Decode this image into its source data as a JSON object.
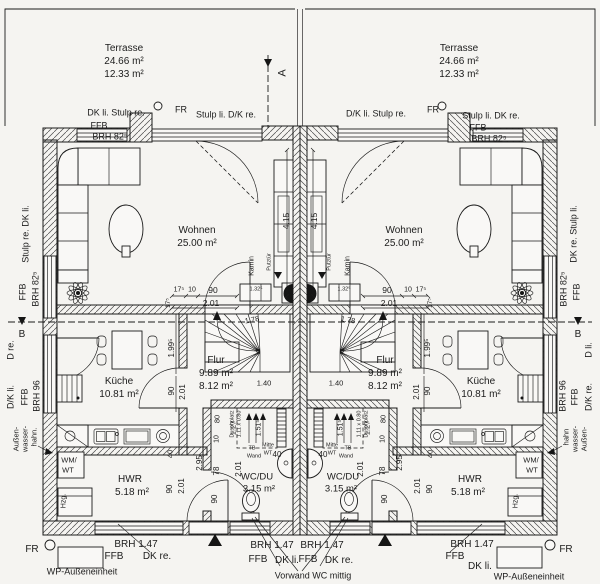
{
  "drawing_type": "floor-plan",
  "rooms": {
    "left_unit": {
      "wohnen": "25.00 m²",
      "kueche": "10.81 m²",
      "flur_1": "9.89 m²",
      "flur_2": "8.12 m²",
      "wc_du": "3.15 m²",
      "hwr": "5.18 m²",
      "terrasse_1": "24.66 m²",
      "terrasse_2": "12.33 m²"
    },
    "right_unit": {
      "wohnen": "25.00 m²",
      "kueche": "10.81 m²",
      "flur_1": "9.89 m²",
      "flur_2": "8.12 m²",
      "wc_du": "3.15 m²",
      "hwr": "5.18 m²",
      "terrasse_1": "24.66 m²",
      "terrasse_2": "12.33 m²"
    }
  },
  "labels": [
    {
      "n": "terrace-left-name",
      "t": "Terrasse",
      "x": 124,
      "y": 49,
      "s": 10
    },
    {
      "n": "terrace-left-area1",
      "t": "24.66 m²",
      "x": 124,
      "y": 62,
      "s": 10
    },
    {
      "n": "terrace-left-area2",
      "t": "12.33 m²",
      "x": 124,
      "y": 75,
      "s": 10
    },
    {
      "n": "terrace-right-name",
      "t": "Terrasse",
      "x": 459,
      "y": 49,
      "s": 10
    },
    {
      "n": "terrace-right-area1",
      "t": "24.66 m²",
      "x": 459,
      "y": 62,
      "s": 10
    },
    {
      "n": "terrace-right-area2",
      "t": "12.33 m²",
      "x": 459,
      "y": 75,
      "s": 10
    },
    {
      "n": "window-label",
      "t": "DK li. Stulp re.",
      "x": 116,
      "y": 113,
      "s": 9
    },
    {
      "n": "window-label",
      "t": "FFB",
      "x": 99,
      "y": 126,
      "s": 9
    },
    {
      "n": "window-label",
      "t": "BRH 82⁵",
      "x": 110,
      "y": 137,
      "s": 9
    },
    {
      "n": "drain-label",
      "t": "FR",
      "x": 181,
      "y": 110,
      "s": 9
    },
    {
      "n": "door-label",
      "t": "Stulp li. D/K re.",
      "x": 226,
      "y": 115,
      "s": 9
    },
    {
      "n": "door-label",
      "t": "D/K li. Stulp re.",
      "x": 376,
      "y": 114,
      "s": 9
    },
    {
      "n": "drain-label",
      "t": "FR",
      "x": 433,
      "y": 110,
      "s": 9
    },
    {
      "n": "window-label",
      "t": "Stulp li. DK re.",
      "x": 491,
      "y": 116,
      "s": 9
    },
    {
      "n": "window-label",
      "t": "FFB",
      "x": 478,
      "y": 128,
      "s": 9
    },
    {
      "n": "window-label",
      "t": "BRH 82⁵",
      "x": 489,
      "y": 139,
      "s": 9
    },
    {
      "n": "section-a-letter",
      "t": "A",
      "x": 283,
      "y": 73,
      "r": -90,
      "s": 11
    },
    {
      "n": "window-label",
      "t": "Stulp re. DK li.",
      "x": 26,
      "y": 234,
      "r": -90,
      "s": 9
    },
    {
      "n": "window-label",
      "t": "FFB",
      "x": 23,
      "y": 292,
      "r": -90,
      "s": 9
    },
    {
      "n": "window-label",
      "t": "BRH 82⁵",
      "x": 36,
      "y": 289,
      "r": -90,
      "s": 9
    },
    {
      "n": "section-b-letter",
      "t": "B",
      "x": 22,
      "y": 335,
      "s": 10
    },
    {
      "n": "door-label",
      "t": "D re.",
      "x": 11,
      "y": 350,
      "r": -90,
      "s": 9
    },
    {
      "n": "door-label",
      "t": "D/K li.",
      "x": 11,
      "y": 397,
      "r": -90,
      "s": 9
    },
    {
      "n": "door-label",
      "t": "FFB",
      "x": 25,
      "y": 397,
      "r": -90,
      "s": 9
    },
    {
      "n": "door-label",
      "t": "BRH 96",
      "x": 37,
      "y": 396,
      "r": -90,
      "s": 9
    },
    {
      "n": "tap-label",
      "t": "Außen-",
      "x": 16,
      "y": 439,
      "r": -90,
      "s": 7.5
    },
    {
      "n": "tap-label",
      "t": "wasser-",
      "x": 25,
      "y": 439,
      "r": -90,
      "s": 7.5
    },
    {
      "n": "tap-label",
      "t": "hahn.",
      "x": 34,
      "y": 437,
      "r": -90,
      "s": 7.5
    },
    {
      "n": "window-label",
      "t": "DK re. Stulp li.",
      "x": 574,
      "y": 234,
      "r": -90,
      "s": 9
    },
    {
      "n": "window-label",
      "t": "FFB",
      "x": 577,
      "y": 292,
      "r": -90,
      "s": 9
    },
    {
      "n": "window-label",
      "t": "BRH 82⁵",
      "x": 564,
      "y": 289,
      "r": -90,
      "s": 9
    },
    {
      "n": "section-b-letter",
      "t": "B",
      "x": 578,
      "y": 335,
      "s": 10
    },
    {
      "n": "door-label",
      "t": "D li.",
      "x": 589,
      "y": 350,
      "r": -90,
      "s": 9
    },
    {
      "n": "door-label",
      "t": "D/K re.",
      "x": 589,
      "y": 397,
      "r": -90,
      "s": 9
    },
    {
      "n": "door-label",
      "t": "FFB",
      "x": 575,
      "y": 397,
      "r": -90,
      "s": 9
    },
    {
      "n": "door-label",
      "t": "BRH 96",
      "x": 563,
      "y": 396,
      "r": -90,
      "s": 9
    },
    {
      "n": "tap-label",
      "t": "Außen-",
      "x": 584,
      "y": 439,
      "r": -90,
      "s": 7.5
    },
    {
      "n": "tap-label",
      "t": "wasser-",
      "x": 575,
      "y": 439,
      "r": -90,
      "s": 7.5
    },
    {
      "n": "tap-label",
      "t": "hahn",
      "x": 566,
      "y": 437,
      "r": -90,
      "s": 7.5
    },
    {
      "n": "room-wohnen-left",
      "t": "Wohnen",
      "x": 197,
      "y": 231,
      "s": 10
    },
    {
      "n": "room-wohnen-left-area",
      "t": "25.00 m²",
      "x": 197,
      "y": 244,
      "s": 10
    },
    {
      "n": "room-wohnen-right",
      "t": "Wohnen",
      "x": 404,
      "y": 231,
      "s": 10
    },
    {
      "n": "room-wohnen-right-area",
      "t": "25.00 m²",
      "x": 404,
      "y": 244,
      "s": 10
    },
    {
      "n": "room-kueche-left",
      "t": "Küche",
      "x": 119,
      "y": 382,
      "s": 10
    },
    {
      "n": "room-kueche-left-area",
      "t": "10.81 m²",
      "x": 119,
      "y": 395,
      "s": 10
    },
    {
      "n": "room-kueche-right",
      "t": "Küche",
      "x": 481,
      "y": 382,
      "s": 10
    },
    {
      "n": "room-kueche-right-area",
      "t": "10.81 m²",
      "x": 481,
      "y": 395,
      "s": 10
    },
    {
      "n": "room-flur-left",
      "t": "Flur",
      "x": 216,
      "y": 361,
      "s": 10
    },
    {
      "n": "room-flur-left-area1",
      "t": "9.89 m²",
      "x": 216,
      "y": 374,
      "s": 10
    },
    {
      "n": "room-flur-left-area2",
      "t": "8.12 m²",
      "x": 216,
      "y": 387,
      "s": 10
    },
    {
      "n": "room-flur-right",
      "t": "Flur",
      "x": 385,
      "y": 361,
      "s": 10
    },
    {
      "n": "room-flur-right-area1",
      "t": "9.89 m²",
      "x": 385,
      "y": 374,
      "s": 10
    },
    {
      "n": "room-flur-right-area2",
      "t": "8.12 m²",
      "x": 385,
      "y": 387,
      "s": 10
    },
    {
      "n": "room-wcdu-left",
      "t": "WC/DU",
      "x": 257,
      "y": 477,
      "s": 9.5
    },
    {
      "n": "room-wcdu-left-area",
      "t": "3.15 m²",
      "x": 259,
      "y": 489,
      "s": 9.5
    },
    {
      "n": "room-wcdu-right",
      "t": "WC/DU",
      "x": 343,
      "y": 477,
      "s": 9.5
    },
    {
      "n": "room-wcdu-right-area",
      "t": "3.15 m²",
      "x": 341,
      "y": 489,
      "s": 9.5
    },
    {
      "n": "room-hwr-left",
      "t": "HWR",
      "x": 130,
      "y": 480,
      "s": 10
    },
    {
      "n": "room-hwr-left-area",
      "t": "5.18 m²",
      "x": 132,
      "y": 493,
      "s": 10
    },
    {
      "n": "room-hwr-right",
      "t": "HWR",
      "x": 470,
      "y": 480,
      "s": 10
    },
    {
      "n": "room-hwr-right-area",
      "t": "5.18 m²",
      "x": 468,
      "y": 493,
      "s": 10
    },
    {
      "n": "appliance-label",
      "t": "WM/",
      "x": 69,
      "y": 460,
      "s": 7.5
    },
    {
      "n": "appliance-label",
      "t": "WT",
      "x": 68,
      "y": 470,
      "s": 7.5
    },
    {
      "n": "appliance-label",
      "t": "WM/",
      "x": 531,
      "y": 460,
      "s": 7.5
    },
    {
      "n": "appliance-label",
      "t": "WT",
      "x": 532,
      "y": 470,
      "s": 7.5
    },
    {
      "n": "appliance-label",
      "t": "Hzg.",
      "x": 64,
      "y": 501,
      "r": -90,
      "s": 7
    },
    {
      "n": "appliance-label",
      "t": "Hzg.",
      "x": 516,
      "y": 501,
      "r": -90,
      "s": 7
    },
    {
      "n": "kamin-label",
      "t": "Kamin",
      "x": 252,
      "y": 266,
      "r": -90,
      "s": 7
    },
    {
      "n": "kamin-label",
      "t": "Kamin",
      "x": 348,
      "y": 266,
      "r": -90,
      "s": 7
    },
    {
      "n": "putztuer-label",
      "t": "Putztür",
      "x": 270,
      "y": 262,
      "r": -90,
      "s": 5.5
    },
    {
      "n": "putztuer-label",
      "t": "Putztür",
      "x": 330,
      "y": 262,
      "r": -90,
      "s": 5.5
    },
    {
      "n": "shower-label",
      "t": "Duschplatz",
      "x": 233,
      "y": 424,
      "r": -90,
      "s": 5.5
    },
    {
      "n": "shower-label",
      "t": "1.11 x 0.80",
      "x": 240,
      "y": 424,
      "r": -90,
      "s": 5.5
    },
    {
      "n": "shower-label",
      "t": "Duschplatz",
      "x": 367,
      "y": 424,
      "r": -90,
      "s": 5.5
    },
    {
      "n": "shower-label",
      "t": "1.11 x 0.80",
      "x": 360,
      "y": 424,
      "r": -90,
      "s": 5.5
    },
    {
      "n": "wall-label",
      "t": "TB",
      "x": 252,
      "y": 449,
      "s": 5.5
    },
    {
      "n": "wall-label",
      "t": "Wand",
      "x": 254,
      "y": 457,
      "s": 5.5
    },
    {
      "n": "wall-label",
      "t": "TB",
      "x": 348,
      "y": 449,
      "s": 5.5
    },
    {
      "n": "wall-label",
      "t": "Wand",
      "x": 346,
      "y": 457,
      "s": 5.5
    },
    {
      "n": "basin-label",
      "t": "Mitte",
      "x": 268,
      "y": 446,
      "s": 5.5
    },
    {
      "n": "basin-label",
      "t": "WT",
      "x": 268,
      "y": 454,
      "s": 5.5
    },
    {
      "n": "basin-label",
      "t": "Mitte",
      "x": 332,
      "y": 446,
      "s": 5.5
    },
    {
      "n": "basin-label",
      "t": "WT",
      "x": 332,
      "y": 454,
      "s": 5.5
    },
    {
      "n": "dim",
      "t": "40",
      "x": 277,
      "y": 455,
      "s": 8
    },
    {
      "n": "dim",
      "t": "40",
      "x": 323,
      "y": 455,
      "s": 8
    },
    {
      "n": "dim",
      "t": "1.51⁵",
      "x": 259,
      "y": 428,
      "r": -90,
      "s": 7
    },
    {
      "n": "dim",
      "t": "1.51⁵",
      "x": 341,
      "y": 428,
      "r": -90,
      "s": 7
    },
    {
      "n": "drain-label",
      "t": "FR",
      "x": 32,
      "y": 550,
      "s": 10
    },
    {
      "n": "drain-label",
      "t": "FR",
      "x": 566,
      "y": 550,
      "s": 10
    },
    {
      "n": "window-label",
      "t": "BRH 1.47",
      "x": 136,
      "y": 545,
      "s": 10
    },
    {
      "n": "window-label",
      "t": "FFB",
      "x": 114,
      "y": 557,
      "s": 10
    },
    {
      "n": "window-label",
      "t": "DK re.",
      "x": 157,
      "y": 557,
      "s": 10
    },
    {
      "n": "wp-label",
      "t": "WP-Außeneinheit",
      "x": 82,
      "y": 572,
      "s": 9
    },
    {
      "n": "wp-label",
      "t": "WP-Außeneinheit",
      "x": 529,
      "y": 577,
      "s": 9
    },
    {
      "n": "window-label",
      "t": "BRH 1.47",
      "x": 272,
      "y": 546,
      "s": 10
    },
    {
      "n": "window-label",
      "t": "FFB",
      "x": 258,
      "y": 560,
      "s": 10
    },
    {
      "n": "window-label",
      "t": "DK li.",
      "x": 287,
      "y": 561,
      "s": 10
    },
    {
      "n": "window-label",
      "t": "BRH 1.47",
      "x": 322,
      "y": 546,
      "s": 10
    },
    {
      "n": "window-label",
      "t": "FFB",
      "x": 308,
      "y": 560,
      "s": 10
    },
    {
      "n": "window-label",
      "t": "DK re.",
      "x": 339,
      "y": 561,
      "s": 10
    },
    {
      "n": "note-vorwand",
      "t": "Vorwand WC mittig",
      "x": 313,
      "y": 576,
      "s": 9
    },
    {
      "n": "window-label",
      "t": "BRH 1.47",
      "x": 472,
      "y": 545,
      "s": 10
    },
    {
      "n": "window-label",
      "t": "FFB",
      "x": 455,
      "y": 557,
      "s": 10
    },
    {
      "n": "window-label",
      "t": "DK li.",
      "x": 480,
      "y": 567,
      "s": 10
    },
    {
      "n": "dim",
      "t": "17⁵",
      "x": 179,
      "y": 290,
      "s": 7
    },
    {
      "n": "dim",
      "t": "10",
      "x": 192,
      "y": 290,
      "s": 7
    },
    {
      "n": "dim",
      "t": "90",
      "x": 213,
      "y": 290,
      "s": 8.5
    },
    {
      "n": "dim",
      "t": "2.01",
      "x": 211,
      "y": 303,
      "s": 8.5
    },
    {
      "n": "dim",
      "t": "90",
      "x": 387,
      "y": 290,
      "s": 8.5
    },
    {
      "n": "dim",
      "t": "10",
      "x": 408,
      "y": 290,
      "s": 7
    },
    {
      "n": "dim",
      "t": "17⁵",
      "x": 421,
      "y": 290,
      "s": 7
    },
    {
      "n": "dim",
      "t": "2.01",
      "x": 389,
      "y": 303,
      "s": 8.5
    },
    {
      "n": "dim",
      "t": "4.15",
      "x": 286,
      "y": 221,
      "r": -90,
      "s": 8.5
    },
    {
      "n": "dim",
      "t": "4.15",
      "x": 314,
      "y": 221,
      "r": -90,
      "s": 8.5
    },
    {
      "n": "dim",
      "t": "1.99⁵",
      "x": 172,
      "y": 348,
      "r": -90,
      "s": 8
    },
    {
      "n": "dim",
      "t": "1.99⁵",
      "x": 428,
      "y": 348,
      "r": -90,
      "s": 8
    },
    {
      "n": "dim",
      "t": "90",
      "x": 172,
      "y": 391,
      "r": -90,
      "s": 8
    },
    {
      "n": "dim",
      "t": "2.01",
      "x": 183,
      "y": 392,
      "r": -90,
      "s": 8
    },
    {
      "n": "dim",
      "t": "90",
      "x": 428,
      "y": 391,
      "r": -90,
      "s": 8
    },
    {
      "n": "dim",
      "t": "2.01",
      "x": 417,
      "y": 392,
      "r": -90,
      "s": 8
    },
    {
      "n": "dim",
      "t": "17⁵",
      "x": 169,
      "y": 303,
      "r": -90,
      "s": 6.5
    },
    {
      "n": "dim",
      "t": "17⁵",
      "x": 431,
      "y": 303,
      "r": -90,
      "s": 6.5
    },
    {
      "n": "dim",
      "t": "2.95",
      "x": 200,
      "y": 463,
      "r": -90,
      "s": 8
    },
    {
      "n": "dim",
      "t": "2.95",
      "x": 400,
      "y": 463,
      "r": -90,
      "s": 8
    },
    {
      "n": "dim",
      "t": "1.27",
      "x": 233,
      "y": 428,
      "r": -90,
      "s": 7.5
    },
    {
      "n": "dim",
      "t": "1.27",
      "x": 367,
      "y": 428,
      "r": -90,
      "s": 7.5
    },
    {
      "n": "dim",
      "t": "78",
      "x": 217,
      "y": 471,
      "r": -90,
      "s": 8
    },
    {
      "n": "dim",
      "t": "78",
      "x": 383,
      "y": 471,
      "r": -90,
      "s": 8
    },
    {
      "n": "dim",
      "t": "90",
      "x": 215,
      "y": 499,
      "r": -90,
      "s": 8
    },
    {
      "n": "dim",
      "t": "90",
      "x": 385,
      "y": 499,
      "r": -90,
      "s": 8
    },
    {
      "n": "dim",
      "t": "2.01",
      "x": 239,
      "y": 469,
      "r": -90,
      "s": 8
    },
    {
      "n": "dim",
      "t": "2.01",
      "x": 361,
      "y": 469,
      "r": -90,
      "s": 8
    },
    {
      "n": "dim",
      "t": "80",
      "x": 217,
      "y": 419,
      "r": -90,
      "s": 7.5
    },
    {
      "n": "dim",
      "t": "80",
      "x": 383,
      "y": 419,
      "r": -90,
      "s": 7.5
    },
    {
      "n": "dim",
      "t": "10",
      "x": 217,
      "y": 439,
      "r": -90,
      "s": 7
    },
    {
      "n": "dim",
      "t": "10",
      "x": 383,
      "y": 439,
      "r": -90,
      "s": 7
    },
    {
      "n": "dim",
      "t": "40",
      "x": 170,
      "y": 454,
      "r": -90,
      "s": 7.5
    },
    {
      "n": "dim",
      "t": "40",
      "x": 430,
      "y": 454,
      "r": -90,
      "s": 7.5
    },
    {
      "n": "dim",
      "t": "90",
      "x": 170,
      "y": 489,
      "r": -90,
      "s": 8
    },
    {
      "n": "dim",
      "t": "90",
      "x": 430,
      "y": 489,
      "r": -90,
      "s": 8
    },
    {
      "n": "dim",
      "t": "2.01",
      "x": 182,
      "y": 486,
      "r": -90,
      "s": 8
    },
    {
      "n": "dim",
      "t": "2.01",
      "x": 418,
      "y": 486,
      "r": -90,
      "s": 8
    },
    {
      "n": "dim",
      "t": "1.78",
      "x": 252,
      "y": 320,
      "r": -10,
      "s": 7.5
    },
    {
      "n": "dim",
      "t": "1.78",
      "x": 348,
      "y": 320,
      "r": 10,
      "s": 7.5
    },
    {
      "n": "dim",
      "t": "1.40",
      "x": 264,
      "y": 383,
      "s": 7.5
    },
    {
      "n": "dim",
      "t": "1.40",
      "x": 336,
      "y": 383,
      "s": 7.5
    },
    {
      "n": "dim",
      "t": "1.32⁵",
      "x": 256,
      "y": 290,
      "s": 5.5
    },
    {
      "n": "dim",
      "t": "1.32⁵",
      "x": 344,
      "y": 290,
      "s": 5.5
    }
  ]
}
